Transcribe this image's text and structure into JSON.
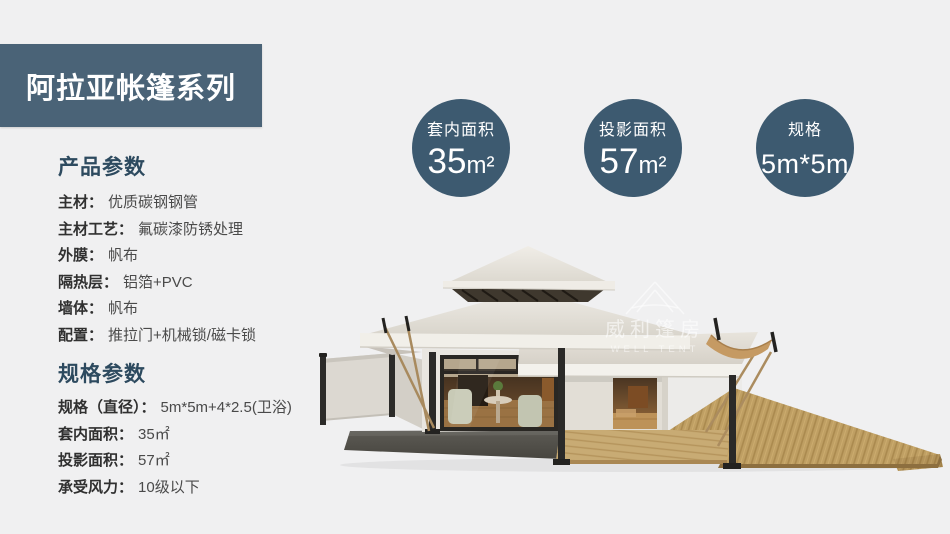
{
  "banner": {
    "title": "阿拉亚帐篷系列"
  },
  "badges": [
    {
      "label": "套内面积",
      "value": "35",
      "unit": "m²"
    },
    {
      "label": "投影面积",
      "value": "57",
      "unit": "m²"
    },
    {
      "label": "规格",
      "value": "5m*5m",
      "unit": ""
    }
  ],
  "sections": [
    {
      "heading": "产品参数",
      "params": [
        {
          "label": "主材：",
          "value": "优质碳钢钢管"
        },
        {
          "label": "主材工艺：",
          "value": "氟碳漆防锈处理"
        },
        {
          "label": "外膜：",
          "value": "帆布"
        },
        {
          "label": "隔热层：",
          "value": "铝箔+PVC"
        },
        {
          "label": "墙体：",
          "value": "帆布"
        },
        {
          "label": "配置：",
          "value": "推拉门+机械锁/磁卡锁"
        }
      ]
    },
    {
      "heading": "规格参数",
      "params": [
        {
          "label": "规格（直径）：",
          "value": "5m*5m+4*2.5(卫浴)"
        },
        {
          "label": "套内面积：",
          "value": "35㎡"
        },
        {
          "label": "投影面积：",
          "value": "57㎡"
        },
        {
          "label": "承受风力：",
          "value": "10级以下"
        }
      ]
    }
  ],
  "watermark": {
    "cn": "威利篷房",
    "en": "WELL TENT"
  },
  "colors": {
    "background": "#f0f0f1",
    "banner": "#4a6377",
    "badge": "#3d5a70",
    "heading": "#2d4a5f",
    "roof": "#e6e2da",
    "deck_wood": "#bf9f63",
    "stone_base": "#55534e"
  }
}
